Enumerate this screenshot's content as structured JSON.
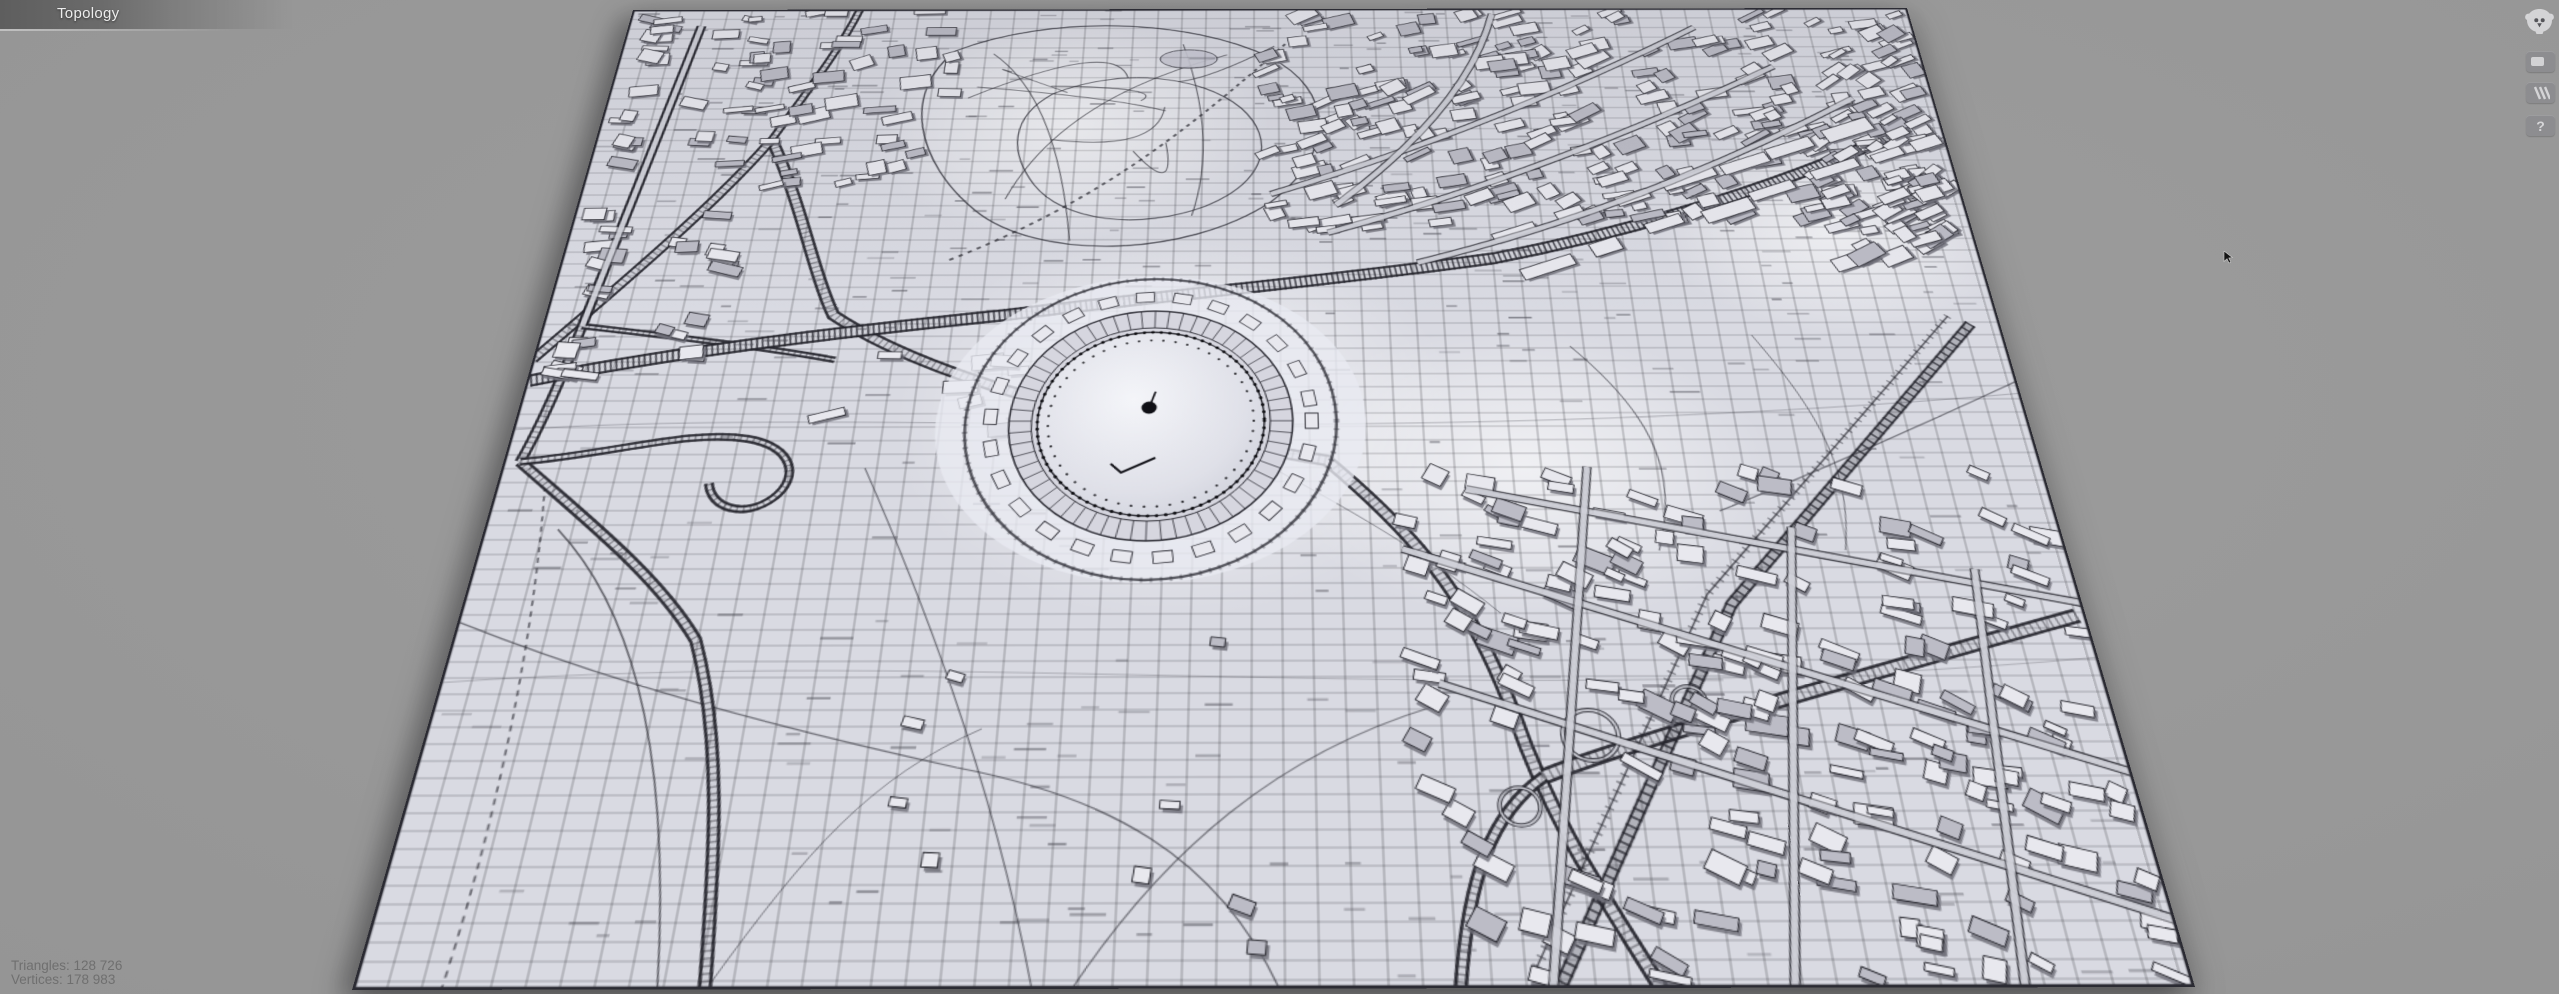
{
  "header": {
    "tab_label": "Topology"
  },
  "toolbar": {
    "logo": {
      "icon": "monkey-head"
    },
    "buttons": [
      {
        "name": "viewer-mode",
        "icon": "rounded-square",
        "label": ""
      },
      {
        "name": "wireframe-stripes",
        "icon": "diagonal-stripes",
        "label": ""
      },
      {
        "name": "help",
        "icon": "question-mark",
        "label": "?"
      }
    ]
  },
  "stats": {
    "lines": [
      "Triangles: 128 726",
      "Vertices: 178 983"
    ],
    "triangles": "128 726",
    "vertices": "178 983"
  },
  "colors": {
    "background": "#9a9a9a",
    "mesh_surface": "#d9dae2",
    "wireframe": "#26262e",
    "building_roof": "#e8e8ee",
    "building_dark_roof": "#bcbcc6",
    "building_shadow": "#6e6e78",
    "tab_text": "#ededed",
    "stats_text": "#6f6f6f"
  }
}
